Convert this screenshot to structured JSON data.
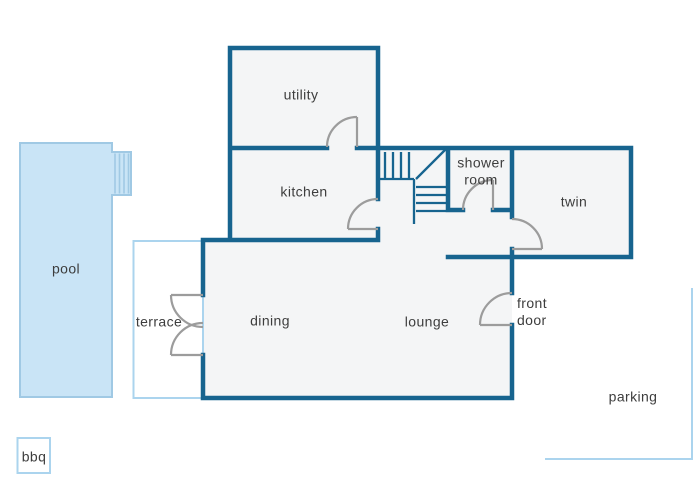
{
  "palette": {
    "wall": "#17648f",
    "door": "#9c9c9c",
    "room_fill": "#f4f5f6",
    "pool_fill": "#c9e4f6",
    "pool_stroke": "#a0c9e4",
    "outdoor_stroke": "#abd4ee",
    "text": "#3d3d3d",
    "background": "#ffffff"
  },
  "rooms": {
    "utility": "utility",
    "kitchen": "kitchen",
    "shower_room": "shower room",
    "twin": "twin",
    "dining": "dining",
    "lounge": "lounge"
  },
  "outdoor": {
    "pool": "pool",
    "terrace": "terrace",
    "parking": "parking",
    "bbq": "bbq"
  },
  "annotations": {
    "front_door": "front door"
  }
}
